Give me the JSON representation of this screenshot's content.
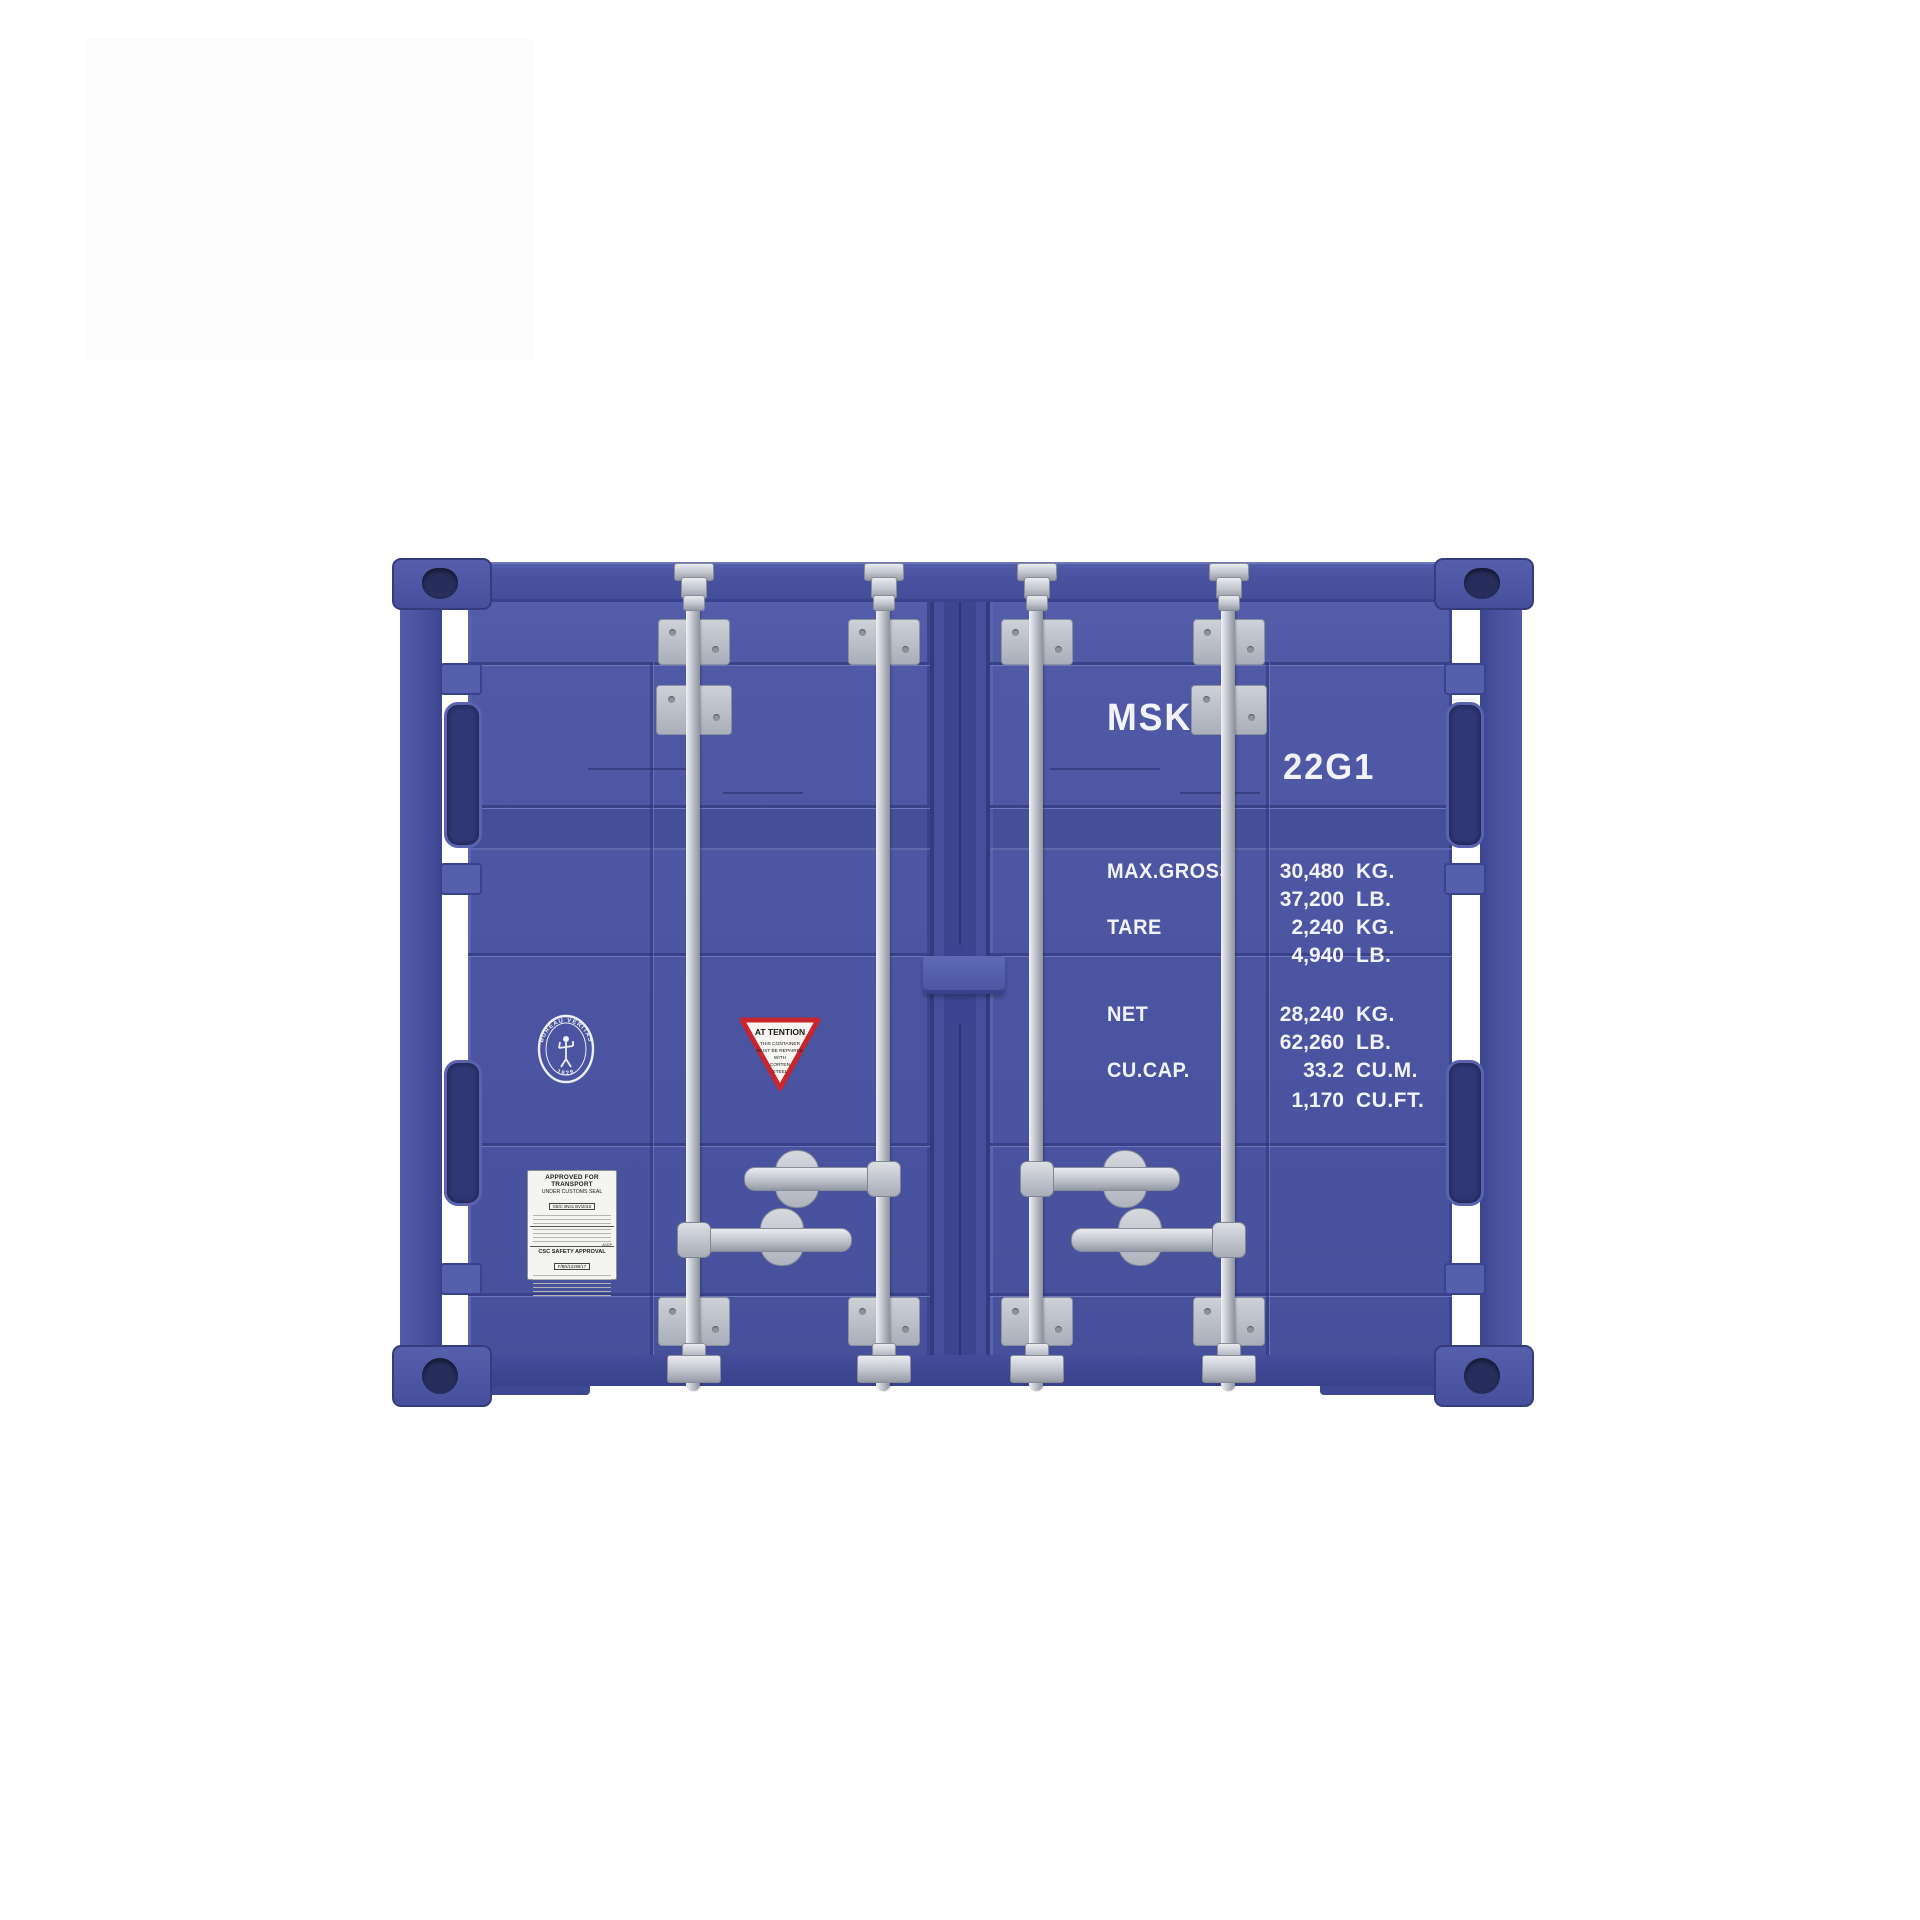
{
  "scene": {
    "background_color": "#ffffff",
    "backdrop_card_color": "#fdfdfd"
  },
  "container": {
    "colors": {
      "body_blue": "#4c56a2",
      "shadow_blue": "#39428c",
      "hardware_silver": "#c6cad2",
      "marking_white": "#f2f3f8",
      "warning_red": "#c8252c"
    },
    "markings": {
      "owner_code": "MSKU",
      "serial_number": "572952",
      "check_digit": "0",
      "size_type_code": "22G1",
      "specs": [
        {
          "label": "MAX.GROSS",
          "values": [
            {
              "value": "30,480",
              "unit": "KG."
            },
            {
              "value": "37,200",
              "unit": "LB."
            }
          ]
        },
        {
          "label": "TARE",
          "values": [
            {
              "value": "2,240",
              "unit": "KG."
            },
            {
              "value": "4,940",
              "unit": "LB."
            }
          ]
        },
        {
          "label": "NET",
          "values": [
            {
              "value": "28,240",
              "unit": "KG."
            },
            {
              "value": "62,260",
              "unit": "LB."
            }
          ]
        },
        {
          "label": "CU.CAP.",
          "values": [
            {
              "value": "33.2",
              "unit": "CU.M."
            },
            {
              "value": "1,170",
              "unit": "CU.FT."
            }
          ]
        }
      ],
      "warning_sticker": {
        "title": "AT TENTION",
        "lines": [
          "THIS CONTAINER",
          "MUST BE REPAIRED",
          "WITH",
          "CORTEN",
          "STEEL"
        ]
      },
      "classification_logo": {
        "arc_text": "BUREAU VERITAS",
        "year": "1828"
      },
      "customs_plate": {
        "line1": "APPROVED FOR TRANSPORT",
        "line2": "UNDER CUSTOMS SEAL",
        "code": "GB/C 8N41 BV/2018"
      },
      "csc_plate": {
        "title": "CSC SAFETY APPROVAL",
        "number": "F/BN/13396/17",
        "column_header": "ACEP"
      }
    }
  }
}
